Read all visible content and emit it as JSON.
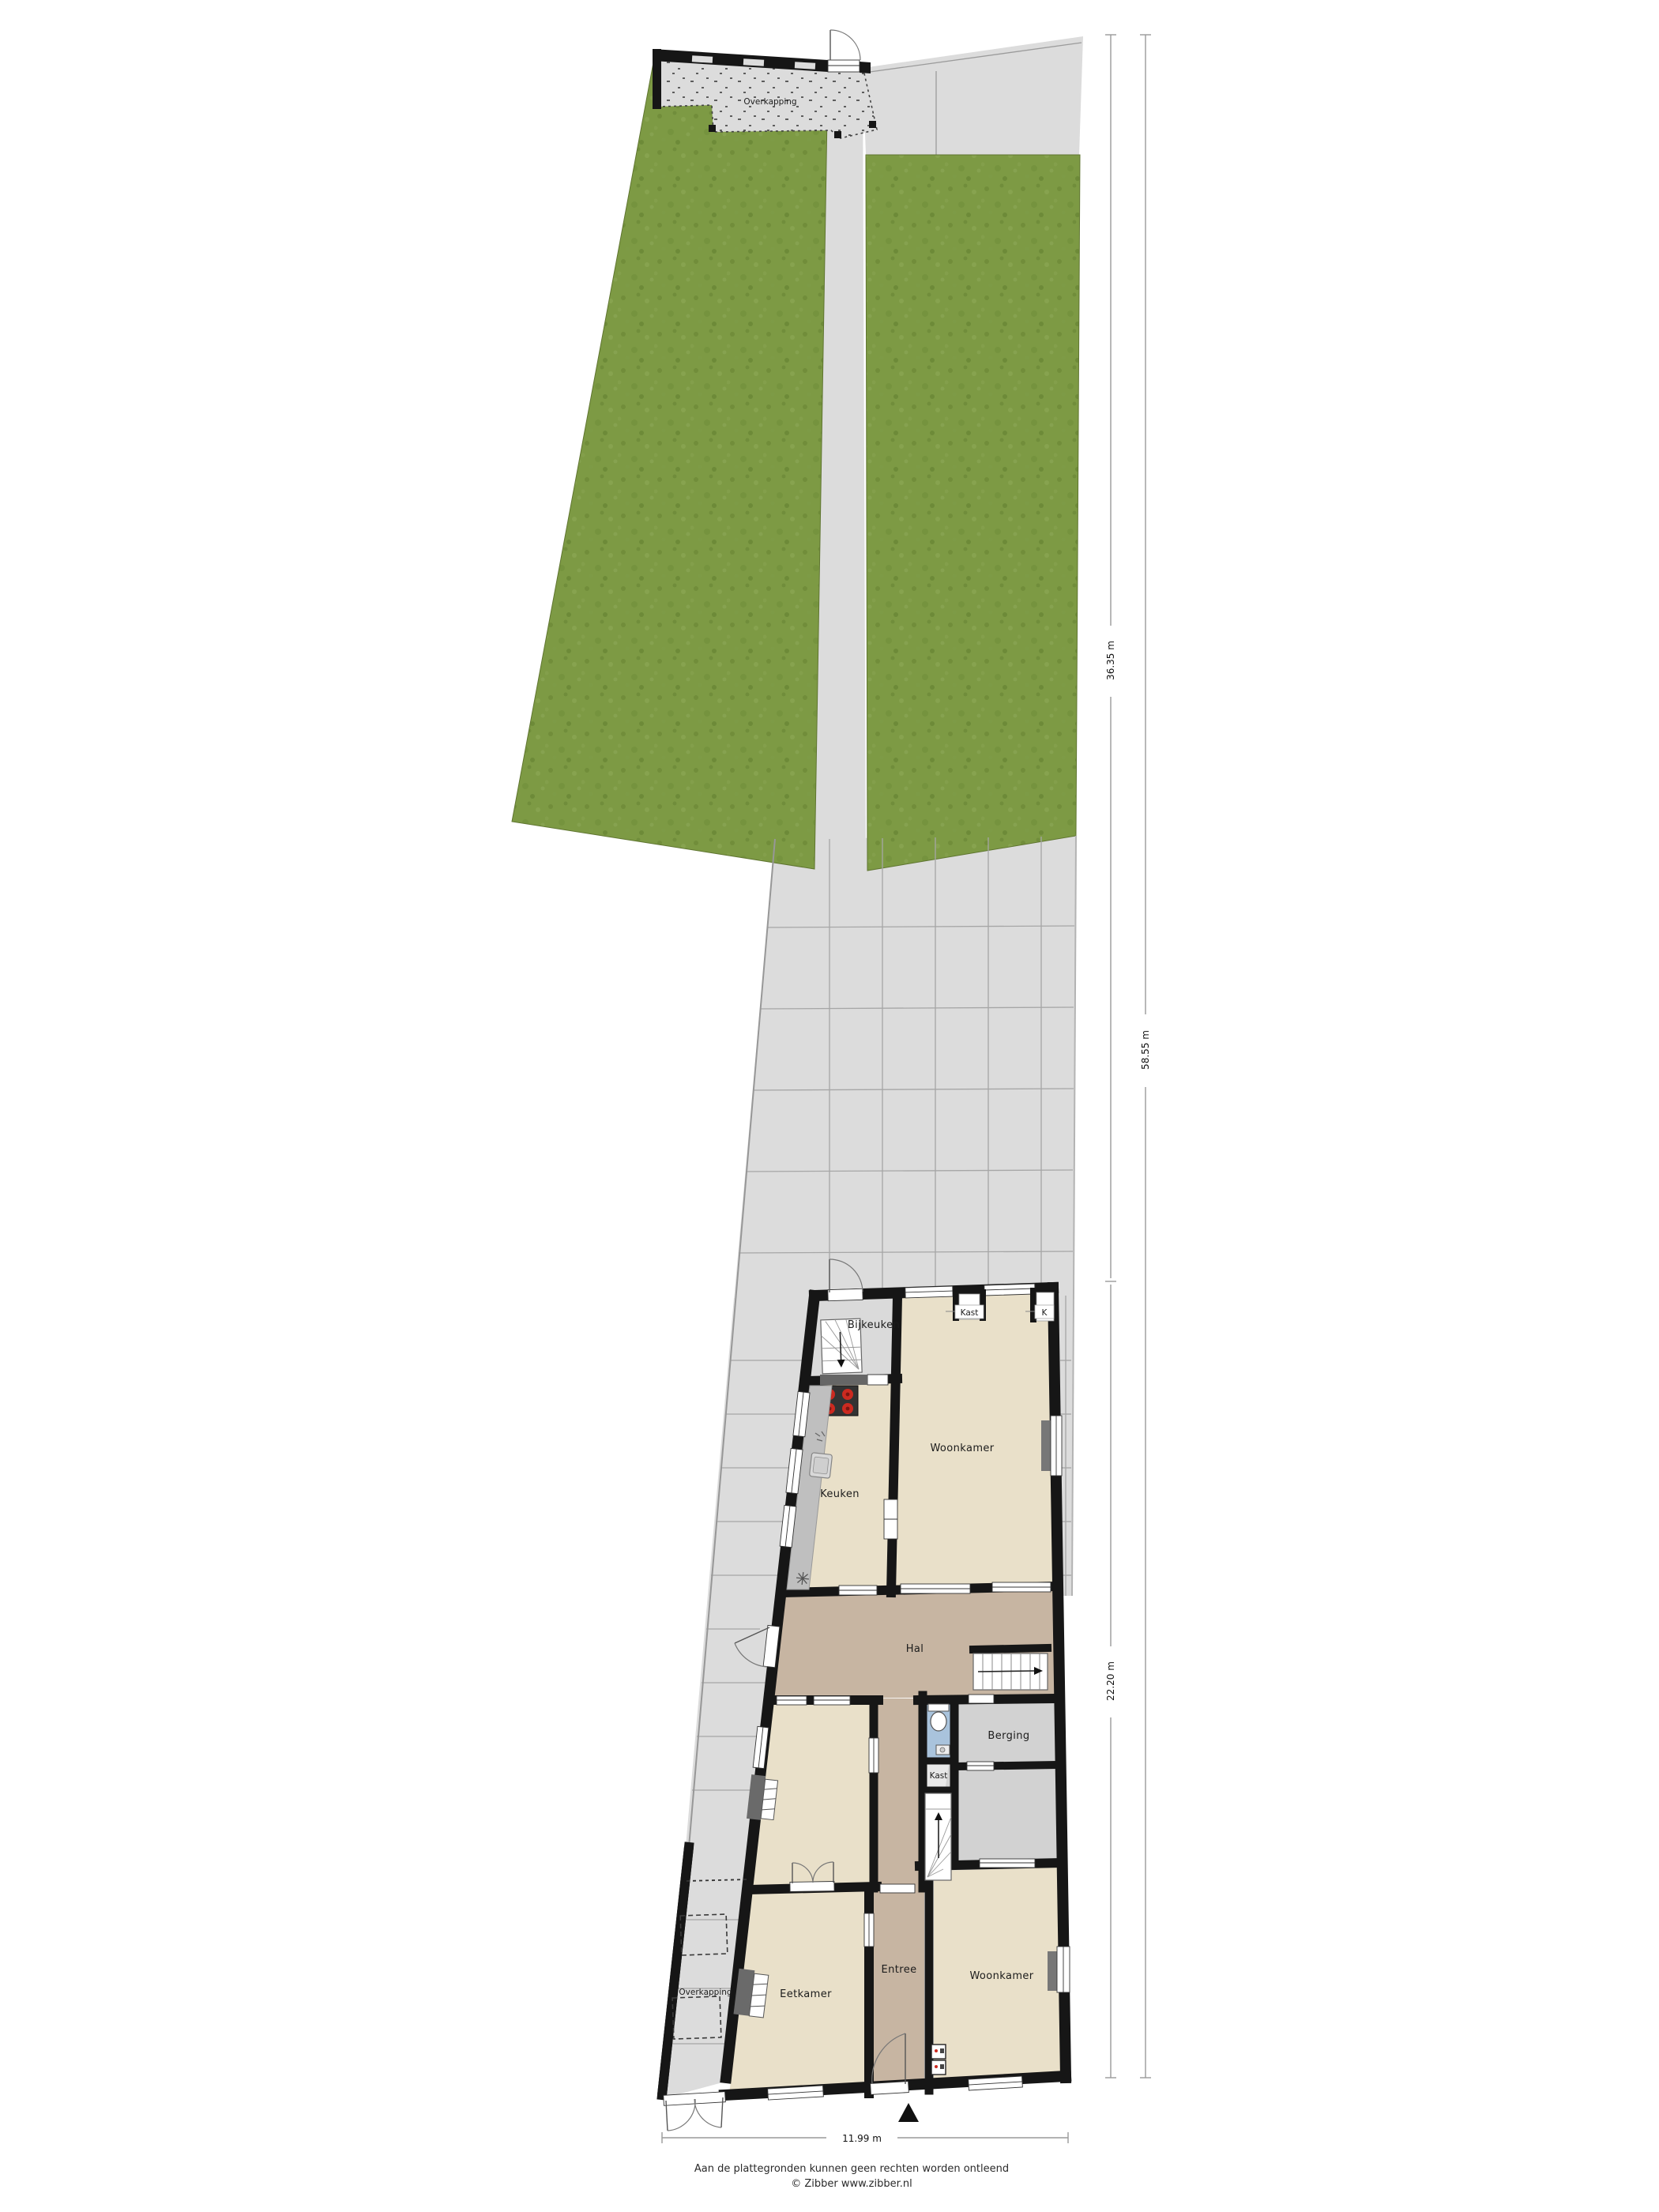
{
  "labels": {
    "overkapping_top": "Overkapping",
    "bijkeuken": "Bijkeuken",
    "kast_top": "Kast",
    "kast_top_right": "K",
    "woonkamer_top": "Woonkamer",
    "keuken": "Keuken",
    "hal": "Hal",
    "berging": "Berging",
    "kast_mid": "Kast",
    "overkapping_side": "Overkapping",
    "eetkamer": "Eetkamer",
    "entree": "Entree",
    "woonkamer_bottom": "Woonkamer"
  },
  "dimensions": {
    "garden_depth": "36.35 m",
    "total_depth": "58.55 m",
    "house_depth": "22.20 m",
    "house_width": "11.99 m"
  },
  "footer": {
    "disclaimer": "Aan de plattegronden kunnen geen rechten worden ontleend",
    "credit": "© Zibber www.zibber.nl"
  },
  "colors": {
    "garden": "#7d9a44",
    "paving": "#dcdcdc",
    "paving_line": "#a6a6a6",
    "room": "#e9e0c9",
    "hall": "#c7b5a2",
    "utility": "#dadada",
    "storage": "#d2d2d2",
    "wc": "#a9c3dc",
    "wall": "#161616",
    "counter": "#bfbfbf",
    "counter_dark": "#666666",
    "stove": "#333333",
    "burner": "#cc2a20",
    "fireplace": "#6a6a6a",
    "dim_line": "#9a9a9a",
    "text": "#1c1c1c"
  }
}
